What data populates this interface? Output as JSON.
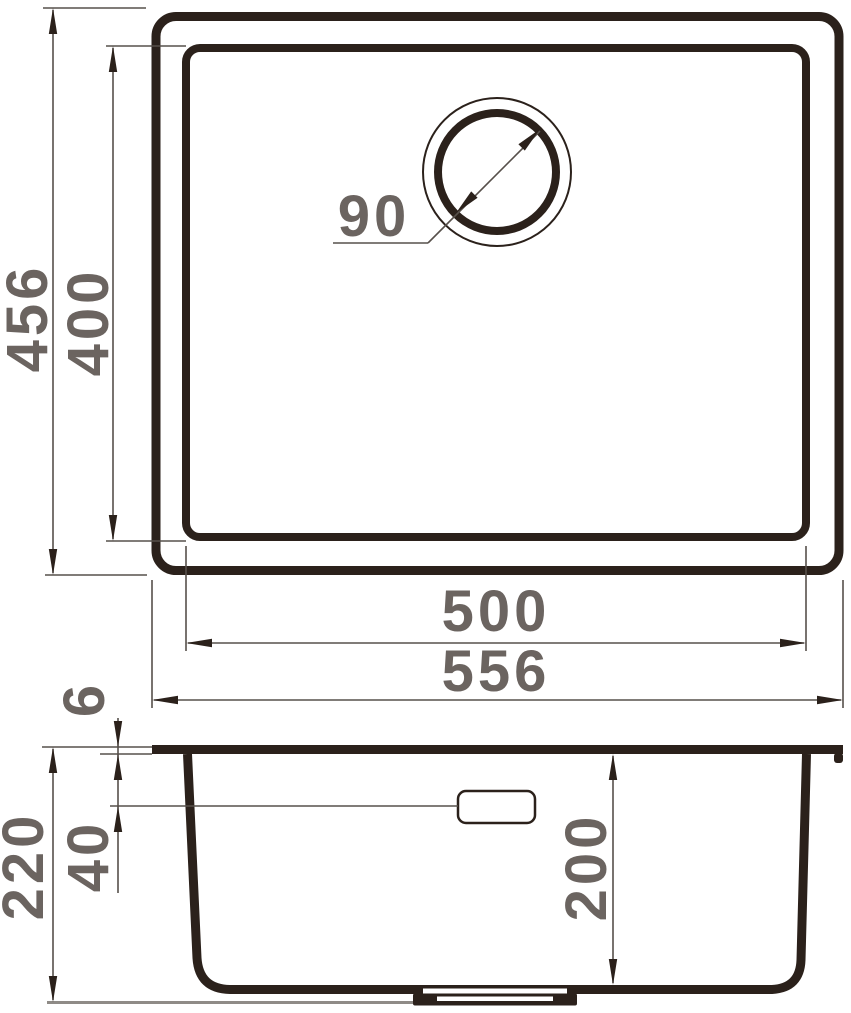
{
  "dimensions": {
    "top_view": {
      "outer_height": "456",
      "inner_height": "400",
      "drain_diameter": "90",
      "inner_width": "500",
      "outer_width": "556"
    },
    "side_view": {
      "rim_thickness": "6",
      "overall_height": "220",
      "overflow_drop": "40",
      "bowl_depth": "200"
    }
  },
  "colors": {
    "outline": "#2b211b",
    "dimension_line": "#57504b",
    "label_text": "#6b6460",
    "ground_line": "#8f8b87",
    "background": "#ffffff"
  }
}
